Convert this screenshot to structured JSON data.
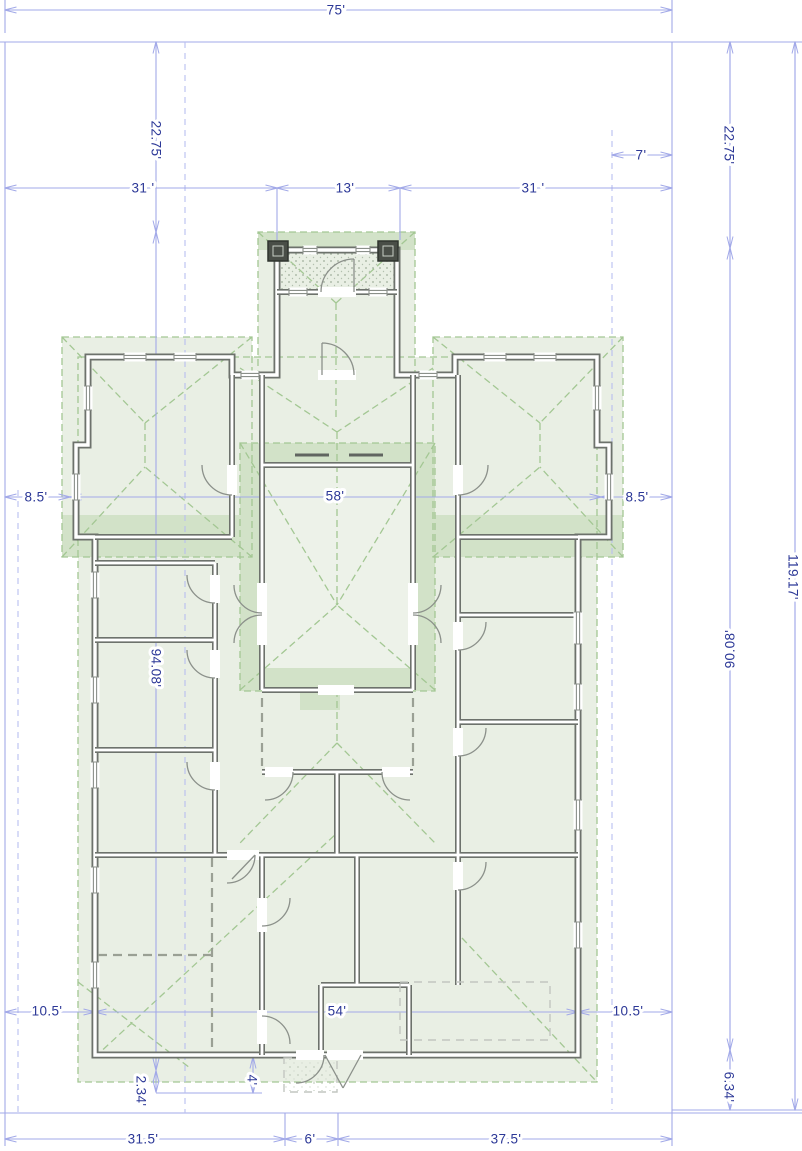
{
  "document": {
    "type": "architectural-floor-plan",
    "units": "feet"
  },
  "colors": {
    "dimension_line": "#a2a9e8",
    "dimension_text": "#2c3897",
    "wall": "#6d726c",
    "roof_fill": "#e9efe4",
    "roof_fill_dark": "#d2e2c8",
    "roof_line": "#a3c793"
  },
  "dimension_labels": [
    {
      "id": "overall-width",
      "text": "75'",
      "x": 336,
      "y": 10,
      "rot": 0
    },
    {
      "id": "left-top-depth",
      "text": "22.75'",
      "x": 156,
      "y": 140,
      "rot": 90
    },
    {
      "id": "porch-side-offset",
      "text": "7'",
      "x": 641,
      "y": 155,
      "rot": 0
    },
    {
      "id": "top-left-width",
      "text": "31 '",
      "x": 143,
      "y": 188,
      "rot": 0
    },
    {
      "id": "porch-width",
      "text": "13'",
      "x": 345,
      "y": 188,
      "rot": 0
    },
    {
      "id": "top-right-width",
      "text": "31 '",
      "x": 533,
      "y": 188,
      "rot": 0
    },
    {
      "id": "right-top-depth",
      "text": "22.75'",
      "x": 729,
      "y": 145,
      "rot": 90
    },
    {
      "id": "left-side-offset",
      "text": "8.5'",
      "x": 36,
      "y": 497,
      "rot": 0
    },
    {
      "id": "body-width",
      "text": "58'",
      "x": 335,
      "y": 496,
      "rot": 0
    },
    {
      "id": "right-side-offset",
      "text": "8.5'",
      "x": 637,
      "y": 497,
      "rot": 0
    },
    {
      "id": "overall-depth",
      "text": "119.17'",
      "x": 793,
      "y": 577,
      "rot": 90
    },
    {
      "id": "body-depth-right",
      "text": "90.08'",
      "x": 730,
      "y": 649,
      "rot": -90
    },
    {
      "id": "body-depth-left",
      "text": "94.08'",
      "x": 156,
      "y": 668,
      "rot": 90
    },
    {
      "id": "bottom-left-inset",
      "text": "10.5'",
      "x": 47,
      "y": 1011,
      "rot": 0
    },
    {
      "id": "bottom-body-width",
      "text": "54'",
      "x": 337,
      "y": 1011,
      "rot": 0
    },
    {
      "id": "bottom-right-inset",
      "text": "10.5'",
      "x": 628,
      "y": 1011,
      "rot": 0
    },
    {
      "id": "stoop-depth",
      "text": "2.34'",
      "x": 141,
      "y": 1091,
      "rot": 90
    },
    {
      "id": "door-offset",
      "text": "4'",
      "x": 252,
      "y": 1080,
      "rot": 90
    },
    {
      "id": "right-bottom-depth",
      "text": "6.34'",
      "x": 729,
      "y": 1087,
      "rot": 90
    },
    {
      "id": "bottom-left-width",
      "text": "31.5'",
      "x": 143,
      "y": 1139,
      "rot": 0
    },
    {
      "id": "bottom-center-width",
      "text": "6'",
      "x": 310,
      "y": 1139,
      "rot": 0
    },
    {
      "id": "bottom-right-width",
      "text": "37.5'",
      "x": 506,
      "y": 1139,
      "rot": 0
    }
  ]
}
